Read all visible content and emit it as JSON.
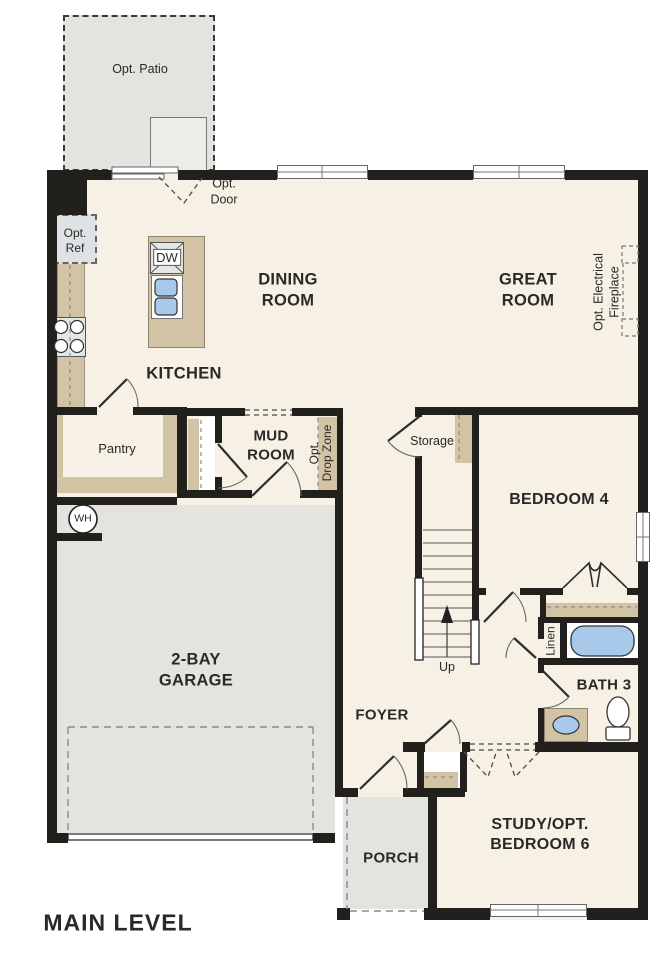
{
  "title": "Floor plan — Main Level",
  "colors": {
    "floor": "#f7f0e4",
    "wall": "#21201d",
    "tan": "#d2c3a5",
    "gray": "#e4e3df",
    "gray_light": "#edece9",
    "blue": "#a9c9ea",
    "fixture": "#e4e6e8",
    "ink": "#2a2927",
    "line": "#555555"
  },
  "labels": {
    "opt_patio": "Opt. Patio",
    "opt_door": "Opt.\nDoor",
    "opt_ref": "Opt.\nRef",
    "dw": "DW",
    "dining_room": "DINING\nROOM",
    "great_room": "GREAT\nROOM",
    "kitchen": "KITCHEN",
    "opt_fireplace": "Opt. Electrical\nFireplace",
    "pantry": "Pantry",
    "mud_room": "MUD\nROOM",
    "opt_drop_zone": "Opt.\nDrop Zone",
    "storage": "Storage",
    "bedroom_4": "BEDROOM 4",
    "water_heater": "WH",
    "garage": "2-BAY\nGARAGE",
    "stairs_up": "Up",
    "linen": "Linen",
    "bath_3": "BATH 3",
    "foyer": "FOYER",
    "porch": "PORCH",
    "study": "STUDY/OPT.\nBEDROOM 6",
    "level": "MAIN LEVEL"
  }
}
